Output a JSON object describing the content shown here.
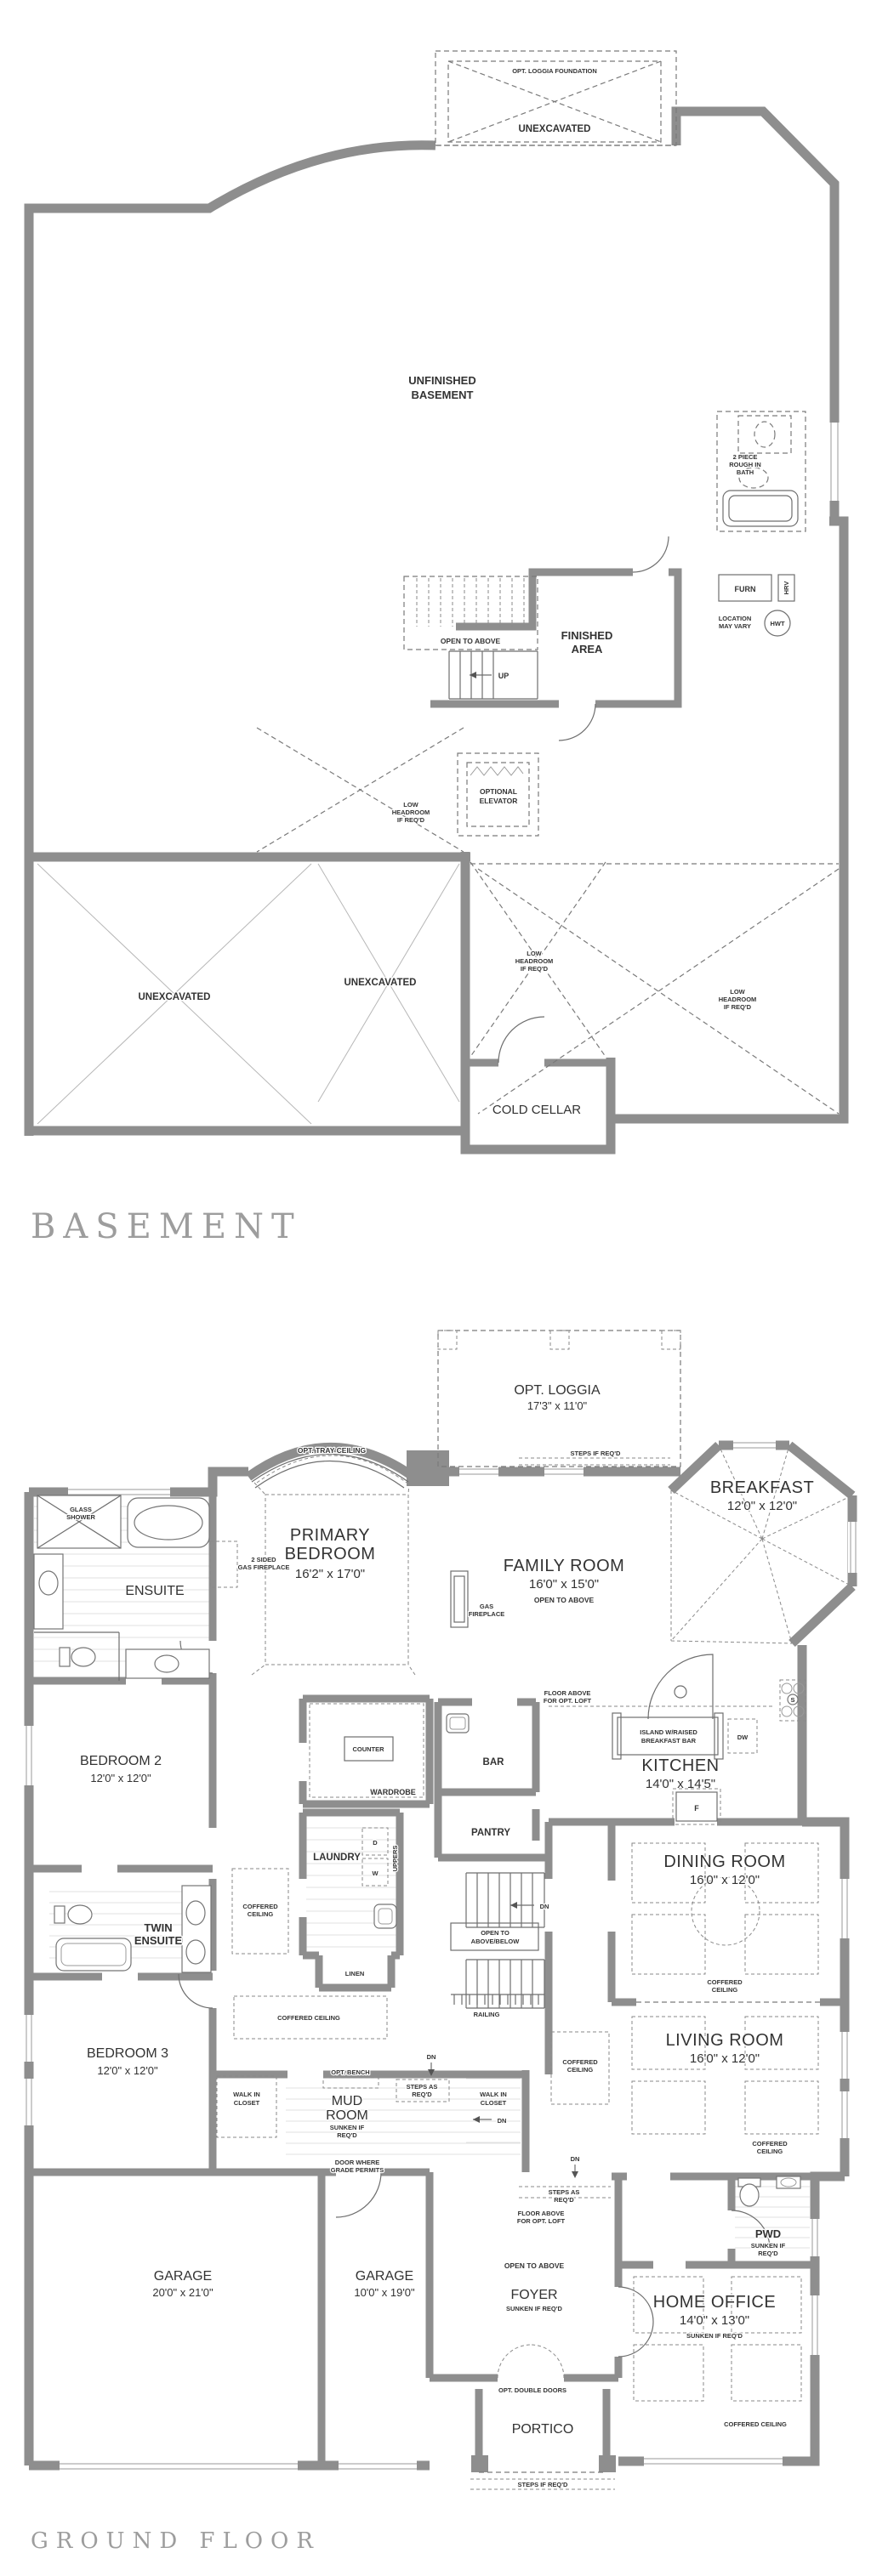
{
  "document": {
    "background": "#ffffff",
    "wall_color": "#8e8e8e",
    "line_color": "#6e6e6e",
    "text_color": "#333333",
    "title_color": "#9d9d9d"
  },
  "basement": {
    "title": "BASEMENT",
    "labels": {
      "loggia_foundation": "OPT. LOGGIA FOUNDATION",
      "unexcavated": "UNEXCAVATED",
      "unfinished_l1": "UNFINISHED",
      "unfinished_l2": "BASEMENT",
      "bath_l1": "2 PIECE",
      "bath_l2": "ROUGH IN",
      "bath_l3": "BATH",
      "open_to_above": "OPEN TO ABOVE",
      "up": "UP",
      "finished_l1": "FINISHED",
      "finished_l2": "AREA",
      "furn": "FURN",
      "hrv": "HRV",
      "hwt": "HWT",
      "location_l1": "LOCATION",
      "location_l2": "MAY VARY",
      "elevator_l1": "OPTIONAL",
      "elevator_l2": "ELEVATOR",
      "low_l1": "LOW",
      "low_l2": "HEADROOM",
      "low_l3": "IF REQ'D",
      "cold_cellar": "COLD CELLAR"
    }
  },
  "ground_floor": {
    "title": "GROUND FLOOR",
    "labels": {
      "opt_loggia": "OPT. LOGGIA",
      "opt_loggia_dims": "17'3\" x 11'0\"",
      "steps_if_reqd": "STEPS IF REQ'D",
      "steps_as_l1": "STEPS AS",
      "steps_as_l2": "REQ'D",
      "breakfast": "BREAKFAST",
      "breakfast_dims": "12'0\" x 12'0\"",
      "primary_l1": "PRIMARY",
      "primary_l2": "BEDROOM",
      "primary_dims": "16'2\" x 17'0\"",
      "tray_ceiling": "OPT. TRAY CEILING",
      "two_sided_l1": "2 SIDED",
      "two_sided_l2": "GAS FIREPLACE",
      "family": "FAMILY ROOM",
      "family_dims": "16'0\" x 15'0\"",
      "open_to_above": "OPEN TO ABOVE",
      "gas_l1": "GAS",
      "gas_l2": "FIREPLACE",
      "glass_l1": "GLASS",
      "glass_l2": "SHOWER",
      "ensuite": "ENSUITE",
      "bedroom2": "BEDROOM 2",
      "bedroom2_dims": "12'0\" x 12'0\"",
      "counter": "COUNTER",
      "wardrobe": "WARDROBE",
      "bar": "BAR",
      "pantry": "PANTRY",
      "kitchen": "KITCHEN",
      "kitchen_dims": "14'0\" x 14'5\"",
      "island_l1": "ISLAND W/RAISED",
      "island_l2": "BREAKFAST BAR",
      "dw": "DW",
      "fridge": "F",
      "stove": "S",
      "floor_above_l1": "FLOOR ABOVE",
      "floor_above_l2": "FOR OPT. LOFT",
      "laundry": "LAUNDRY",
      "washer": "W",
      "dryer": "D",
      "uppers": "UPPERS",
      "linen": "LINEN",
      "open_ab_l1": "OPEN TO",
      "open_ab_l2": "ABOVE/BELOW",
      "dn": "DN",
      "railing": "RAILING",
      "dining": "DINING ROOM",
      "dining_dims": "16'0\" x 12'0\"",
      "living": "LIVING ROOM",
      "living_dims": "16'0\" x 12'0\"",
      "coffered_l1": "COFFERED",
      "coffered_l2": "CEILING",
      "coffered_inline": "COFFERED CEILING",
      "twin_l1": "TWIN",
      "twin_l2": "ENSUITE",
      "bedroom3": "BEDROOM 3",
      "bedroom3_dims": "12'0\" x 12'0\"",
      "wic_l1": "WALK IN",
      "wic_l2": "CLOSET",
      "opt_bench": "OPT. BENCH",
      "mud_l1": "MUD",
      "mud_l2": "ROOM",
      "sunken_l1": "SUNKEN IF",
      "sunken_l2": "REQ'D",
      "sunken_inline": "SUNKEN IF REQ'D",
      "door_grade_l1": "DOOR WHERE",
      "door_grade_l2": "GRADE PERMITS",
      "garage1": "GARAGE",
      "garage1_dims": "20'0\" x 21'0\"",
      "garage2": "GARAGE",
      "garage2_dims": "10'0\" x 19'0\"",
      "foyer": "FOYER",
      "pwd": "PWD",
      "home_office": "HOME OFFICE",
      "home_office_dims": "14'0\" x 13'0\"",
      "opt_double_doors": "OPT. DOUBLE DOORS",
      "portico": "PORTICO"
    }
  }
}
